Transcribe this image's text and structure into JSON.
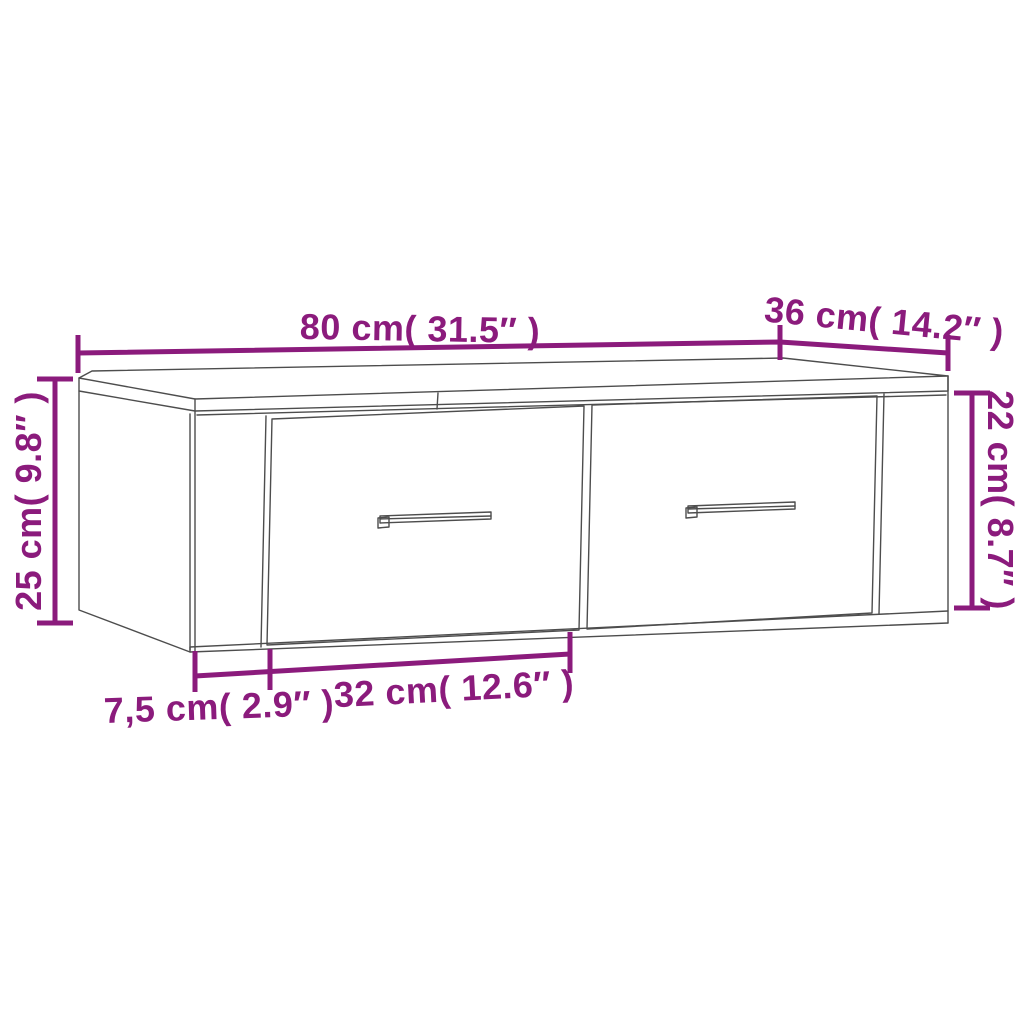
{
  "diagram": {
    "type": "product-dimension-diagram",
    "subject": "wall-mounted cabinet with two drawers",
    "background_color": "#ffffff"
  },
  "palette": {
    "dimension_color": "#8b1b7c",
    "line_art_color": "#4d4d4d"
  },
  "dimensions": {
    "overall_width": "80 cm( 31.5″ )",
    "depth": "36 cm( 14.2″ )",
    "overall_height": "25 cm( 9.8″ )",
    "front_height": "22 cm( 8.7″ )",
    "side_width": "7,5 cm( 2.9″ )",
    "drawer_width": "32 cm( 12.6″ )"
  }
}
